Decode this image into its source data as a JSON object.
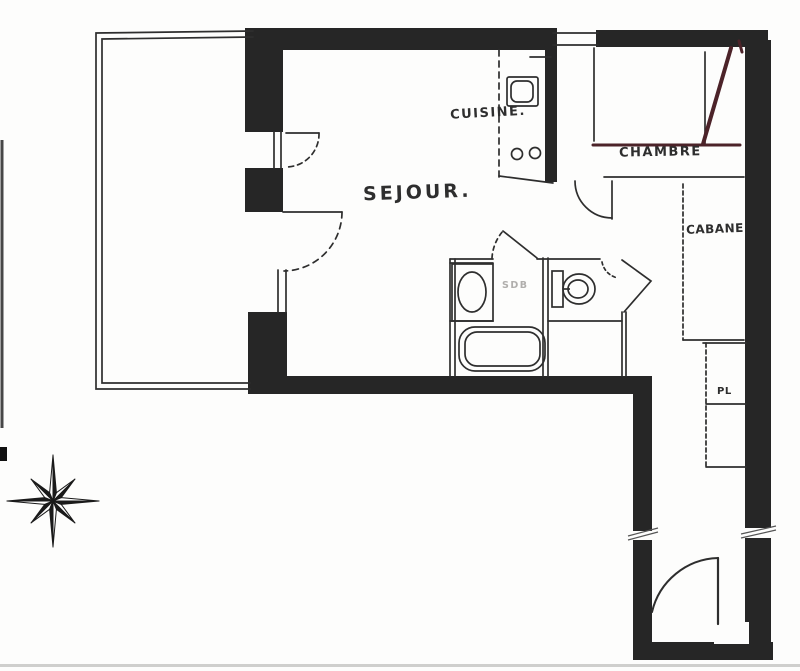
{
  "plan": {
    "labels": {
      "sejour": "SEJOUR.",
      "cuisine": "CUISINE.",
      "chambre": "CHAMBRE",
      "cabane": "CABANE",
      "closet": "PL",
      "bathroom": "SDB"
    },
    "colors": {
      "wall": "#262626",
      "ink": "#2e2e2e",
      "red_pen": "#4c2329",
      "faint_text": "#b0aeac",
      "paper": "#fdfdfc",
      "artifact": "#474747"
    },
    "icons": {
      "compass": "compass-rose-icon"
    }
  }
}
